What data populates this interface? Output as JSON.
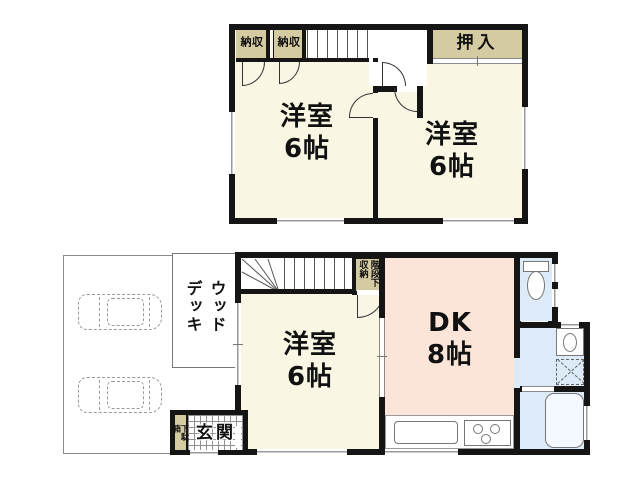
{
  "floor2": {
    "closet_left": "収納",
    "closet_right": "収納",
    "oshiire": "押入",
    "room_left_name": "洋室",
    "room_left_size": "6帖",
    "room_right_name": "洋室",
    "room_right_size": "6帖"
  },
  "floor1": {
    "room_name": "洋室",
    "room_size": "6帖",
    "dk_name": "DK",
    "dk_size": "8帖",
    "under_stair_storage": "階段下収納",
    "entrance": "玄関",
    "shoe_cabinet": "下駄箱",
    "wood_deck": "ウッドデッキ"
  },
  "colors": {
    "room_cream": "#FAF6E4",
    "closet_beige": "#D5CBA3",
    "dk_pink": "#FAE5D8",
    "wet_area_blue": "#DCEBF7",
    "wall_black": "#151515",
    "window_gray": "#9A9A9A"
  }
}
